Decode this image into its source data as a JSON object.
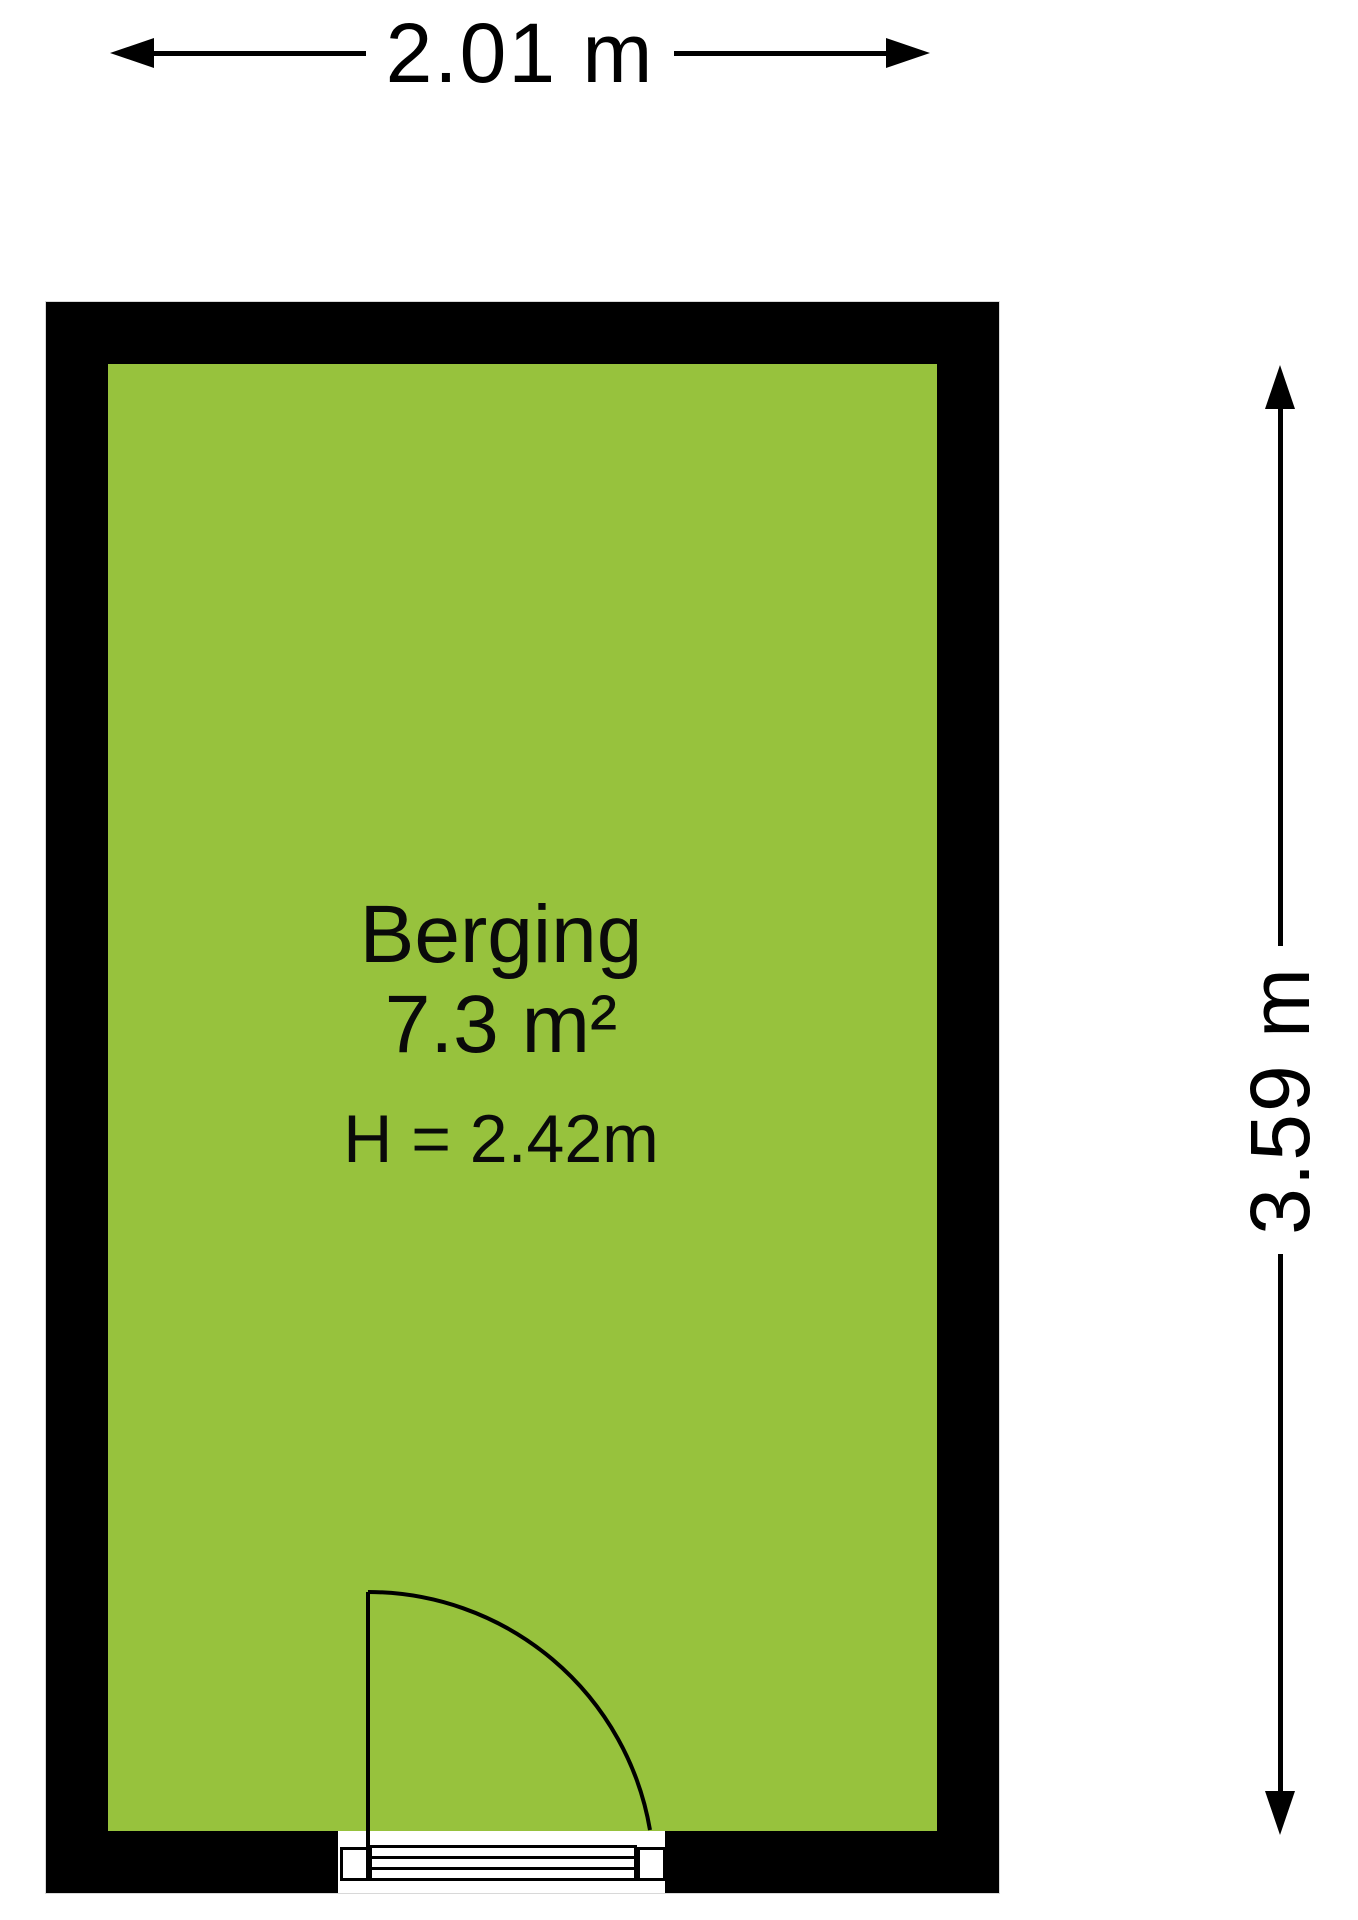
{
  "plan": {
    "room": {
      "name": "Berging",
      "area": "7.3 m²",
      "ceiling_height": "H = 2.42m"
    },
    "dimensions": {
      "width": "2.01 m",
      "height": "3.59 m"
    },
    "colors": {
      "floor": "#97C23D",
      "wall": "#000000",
      "background": "#FFFFFF"
    }
  }
}
